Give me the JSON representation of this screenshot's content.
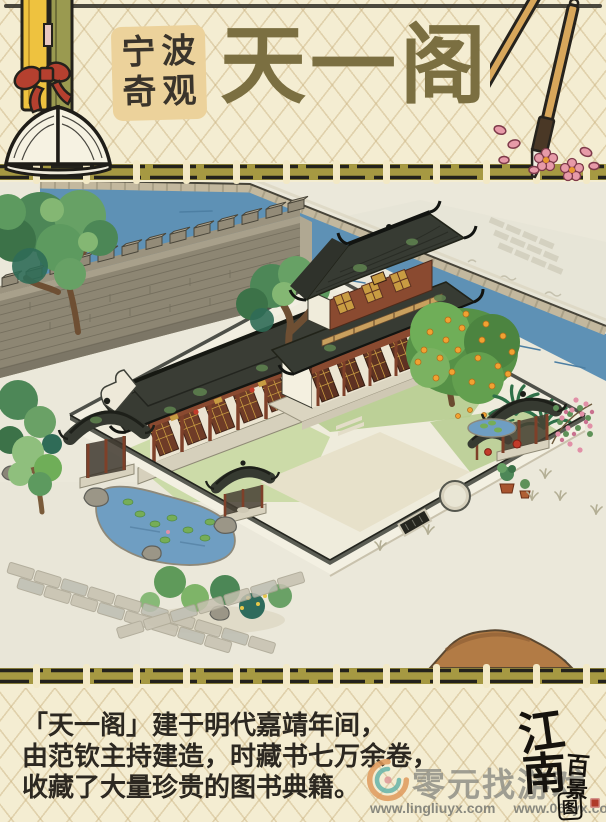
{
  "header": {
    "badge": {
      "line1": "宁波",
      "line2": "奇观"
    },
    "title": "天一阁"
  },
  "description": {
    "line1": "「天一阁」建于明代嘉靖年间，",
    "line2": "由范钦主持建造，时藏书七万余卷，",
    "line3": "收藏了大量珍贵的图书典籍。"
  },
  "game_logo": {
    "jiang": "江",
    "nan": "南",
    "bai": "百",
    "jing": "景",
    "tu": "图"
  },
  "watermark": {
    "site_name": "零元找游戏",
    "url_left": "www.lingliuyx.com",
    "url_right": "www.06zyx.com"
  },
  "icons": {
    "header_left": "open-book-with-scrolls",
    "header_right": "calligraphy-brushes-with-petals",
    "watermark_logo": "orange-teal-swirl"
  },
  "colors": {
    "paper": "#f4edd2",
    "band_olive": "#a69942",
    "band_ink": "#23221c",
    "band_tie": "#f3e9c6",
    "title_olive": "#7b6f41",
    "badge_bg": "#ecd29b",
    "river_blue": "#5e91b5",
    "roof_dark": "#373a32",
    "wall_gray": "#8d8572",
    "wood_red": "#7e4029",
    "gold": "#c89c42",
    "accent_red": "#b5402f",
    "seal_red": "#b03a2a",
    "orange_fruit": "#f1a232",
    "pink_flower": "#e190a7",
    "hill_brown": "#b27b45",
    "watermark_gray": "#8c8c84",
    "text_ink": "#2c2821"
  }
}
